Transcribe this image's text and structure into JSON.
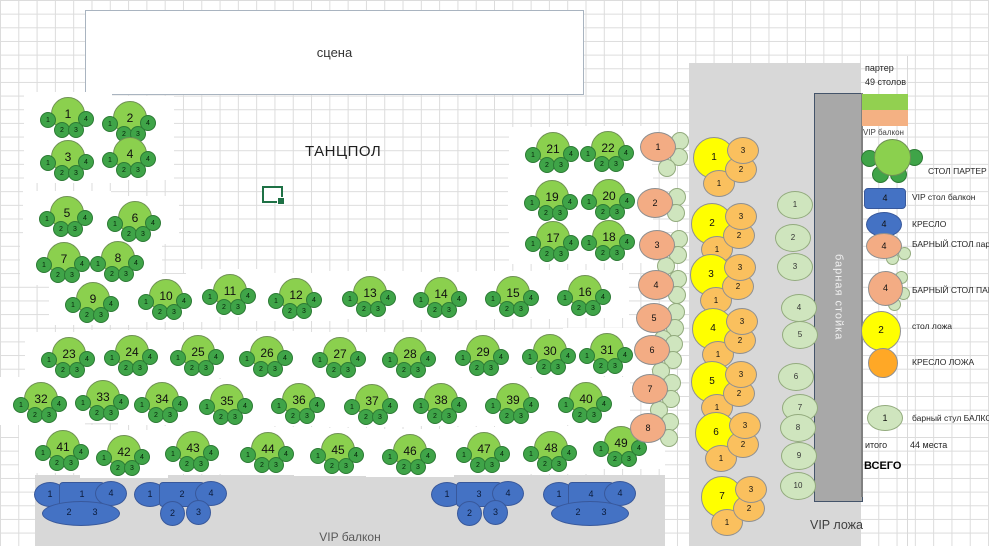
{
  "stage_label": "сцена",
  "dancefloor_label": "ТАНЦПОЛ",
  "balcony_caption": "VIP балкон",
  "lodge_caption": "VIP ложа",
  "bar_caption": "барная стойка",
  "seat_labels": [
    "1",
    "2",
    "3",
    "4"
  ],
  "lodge_chair_labels": [
    "1",
    "2",
    "3"
  ],
  "balcony_side_labels": {
    "left": "1",
    "right": "4"
  },
  "balcony_bottom_labels": [
    "2",
    "3"
  ],
  "parter_tables": [
    [
      "1",
      68,
      114
    ],
    [
      "2",
      130,
      118
    ],
    [
      "3",
      68,
      157
    ],
    [
      "4",
      130,
      154
    ],
    [
      "5",
      67,
      213
    ],
    [
      "6",
      135,
      218
    ],
    [
      "7",
      64,
      259
    ],
    [
      "8",
      118,
      258
    ],
    [
      "9",
      93,
      299
    ],
    [
      "10",
      166,
      296
    ],
    [
      "11",
      230,
      291
    ],
    [
      "12",
      296,
      295
    ],
    [
      "13",
      370,
      293
    ],
    [
      "14",
      441,
      294
    ],
    [
      "15",
      513,
      293
    ],
    [
      "16",
      585,
      292
    ],
    [
      "17",
      553,
      238
    ],
    [
      "18",
      609,
      237
    ],
    [
      "19",
      552,
      197
    ],
    [
      "20",
      609,
      196
    ],
    [
      "21",
      553,
      149
    ],
    [
      "22",
      608,
      148
    ],
    [
      "23",
      69,
      354
    ],
    [
      "24",
      132,
      352
    ],
    [
      "25",
      198,
      352
    ],
    [
      "26",
      267,
      353
    ],
    [
      "27",
      340,
      354
    ],
    [
      "28",
      410,
      354
    ],
    [
      "29",
      483,
      352
    ],
    [
      "30",
      550,
      351
    ],
    [
      "31",
      607,
      350
    ],
    [
      "32",
      41,
      399
    ],
    [
      "33",
      103,
      397
    ],
    [
      "34",
      162,
      399
    ],
    [
      "35",
      227,
      401
    ],
    [
      "36",
      299,
      400
    ],
    [
      "37",
      372,
      401
    ],
    [
      "38",
      441,
      400
    ],
    [
      "39",
      513,
      400
    ],
    [
      "40",
      586,
      399
    ],
    [
      "41",
      63,
      447
    ],
    [
      "42",
      124,
      452
    ],
    [
      "43",
      193,
      448
    ],
    [
      "44",
      268,
      449
    ],
    [
      "45",
      338,
      450
    ],
    [
      "46",
      410,
      451
    ],
    [
      "47",
      484,
      449
    ],
    [
      "48",
      551,
      448
    ],
    [
      "49",
      621,
      443
    ]
  ],
  "parter_bar_tables": [
    [
      "1",
      658,
      147,
      3
    ],
    [
      "2",
      655,
      203,
      2
    ],
    [
      "3",
      657,
      245,
      3
    ],
    [
      "4",
      656,
      285,
      2
    ],
    [
      "5",
      654,
      318,
      3
    ],
    [
      "6",
      652,
      350,
      3
    ],
    [
      "7",
      650,
      389,
      3
    ],
    [
      "8",
      648,
      428,
      2
    ]
  ],
  "lodge_tables": [
    [
      "1",
      714,
      158
    ],
    [
      "2",
      712,
      224
    ],
    [
      "3",
      711,
      275
    ],
    [
      "4",
      713,
      329
    ],
    [
      "5",
      712,
      382
    ],
    [
      "6",
      716,
      433
    ],
    [
      "7",
      722,
      497
    ]
  ],
  "lodge_stools": [
    [
      "1",
      795,
      205
    ],
    [
      "2",
      793,
      238
    ],
    [
      "3",
      795,
      267
    ],
    [
      "4",
      799,
      308
    ],
    [
      "5",
      800,
      335
    ],
    [
      "6",
      796,
      377
    ],
    [
      "7",
      800,
      408
    ],
    [
      "8",
      798,
      428
    ],
    [
      "9",
      799,
      456
    ],
    [
      "10",
      798,
      486
    ]
  ],
  "balcony_groups": [
    {
      "table": "1",
      "cx": 82,
      "cy": 494,
      "bottom": "wide"
    },
    {
      "table": "2",
      "cx": 182,
      "cy": 494,
      "bottom": "circles"
    },
    {
      "table": "3",
      "cx": 479,
      "cy": 494,
      "bottom": "circles"
    },
    {
      "table": "4",
      "cx": 591,
      "cy": 494,
      "bottom": "wide"
    }
  ],
  "legend": {
    "header_line1": "партер",
    "header_line2": "49 столов",
    "swatch_green": "#92D050",
    "swatch_orange": "#F4B183",
    "section_caption": "VIP балкон",
    "items": [
      {
        "label": "СТОЛ ПАРТЕР",
        "value": ""
      },
      {
        "label": "VIP стол балкон",
        "value": "4"
      },
      {
        "label": "КРЕСЛО",
        "value": "4"
      },
      {
        "label": "БАРНЫЙ СТОЛ партер",
        "value": "4"
      },
      {
        "label": "БАРНЫЙ СТОЛ ПАРТЕР",
        "value": "4"
      },
      {
        "label": "стол ложа",
        "value": "2"
      },
      {
        "label": "КРЕСЛО ЛОЖА",
        "value": ""
      },
      {
        "label": "барный стул БАЛКОН",
        "value": "1"
      }
    ],
    "totals_label": "итого",
    "totals_value": "44 места",
    "grand_total_label": "ВСЕГО"
  }
}
